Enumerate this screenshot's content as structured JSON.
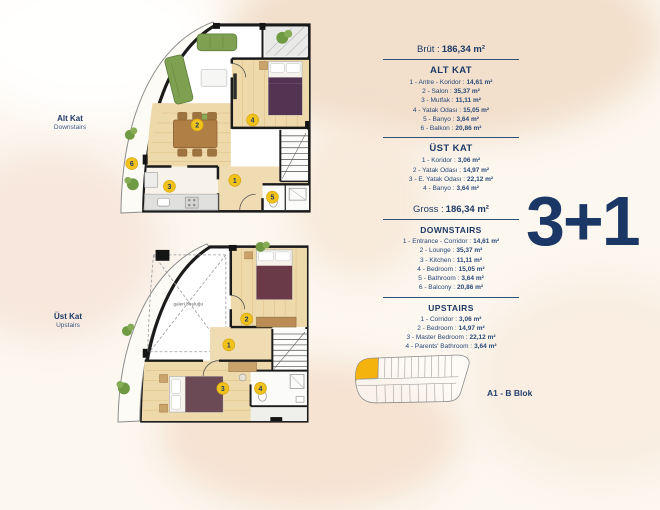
{
  "page": {
    "unit_type": "3+1",
    "block_label": "A1 - B Blok"
  },
  "plans": {
    "alt": {
      "title": "Alt Kat",
      "subtitle": "Downstairs",
      "badges": {
        "b1": "1",
        "b2": "2",
        "b3": "3",
        "b4": "4",
        "b5": "5",
        "b6": "6"
      }
    },
    "ust": {
      "title": "Üst Kat",
      "subtitle": "Upstairs",
      "void_label": "galeri boşluğu",
      "badges": {
        "b1": "1",
        "b2": "2",
        "b3": "3",
        "b4": "4"
      }
    }
  },
  "info": {
    "brut_label": "Brüt :",
    "brut_value": "186,34 m²",
    "gross_label": "Gross :",
    "gross_value": "186,34 m²",
    "alt_kat": {
      "title": "ALT KAT",
      "items": [
        {
          "label": "1 - Antre - Koridor :",
          "value": "14,61 m²"
        },
        {
          "label": "2 - Salon :",
          "value": "35,37 m²"
        },
        {
          "label": "3 - Mutfak :",
          "value": "11,11 m²"
        },
        {
          "label": "4 - Yatak Odası :",
          "value": "15,05 m²"
        },
        {
          "label": "5 - Banyo :",
          "value": "3,64 m²"
        },
        {
          "label": "6 - Balkon :",
          "value": "20,86 m²"
        }
      ]
    },
    "ust_kat": {
      "title": "ÜST KAT",
      "items": [
        {
          "label": "1 - Koridor :",
          "value": "3,06 m²"
        },
        {
          "label": "2 - Yatak Odası :",
          "value": "14,97 m²"
        },
        {
          "label": "3 - E. Yatak Odası :",
          "value": "22,12 m²"
        },
        {
          "label": "4 - Banyo :",
          "value": "3,64 m²"
        }
      ]
    },
    "downstairs": {
      "title": "DOWNSTAIRS",
      "items": [
        {
          "label": "1 - Entrance - Corridor :",
          "value": "14,61 m²"
        },
        {
          "label": "2 - Lounge :",
          "value": "35,37 m²"
        },
        {
          "label": "3 - Kitchen :",
          "value": "11,11 m²"
        },
        {
          "label": "4 - Bedroom :",
          "value": "15,05 m²"
        },
        {
          "label": "5 - Bathroom :",
          "value": "3,64 m²"
        },
        {
          "label": "6 - Balcony :",
          "value": "20,86 m²"
        }
      ]
    },
    "upstairs": {
      "title": "UPSTAIRS",
      "items": [
        {
          "label": "1 - Corridor :",
          "value": "3,06 m²"
        },
        {
          "label": "2 - Bedroom :",
          "value": "14,97 m²"
        },
        {
          "label": "3 - Master Bedroom :",
          "value": "22,12 m²"
        },
        {
          "label": "4 - Parents' Bathroom :",
          "value": "3,64 m²"
        }
      ]
    }
  },
  "colors": {
    "navy": "#1d3a66",
    "badge_yellow": "#f2c21c",
    "highlight_yellow": "#f5b30d"
  }
}
